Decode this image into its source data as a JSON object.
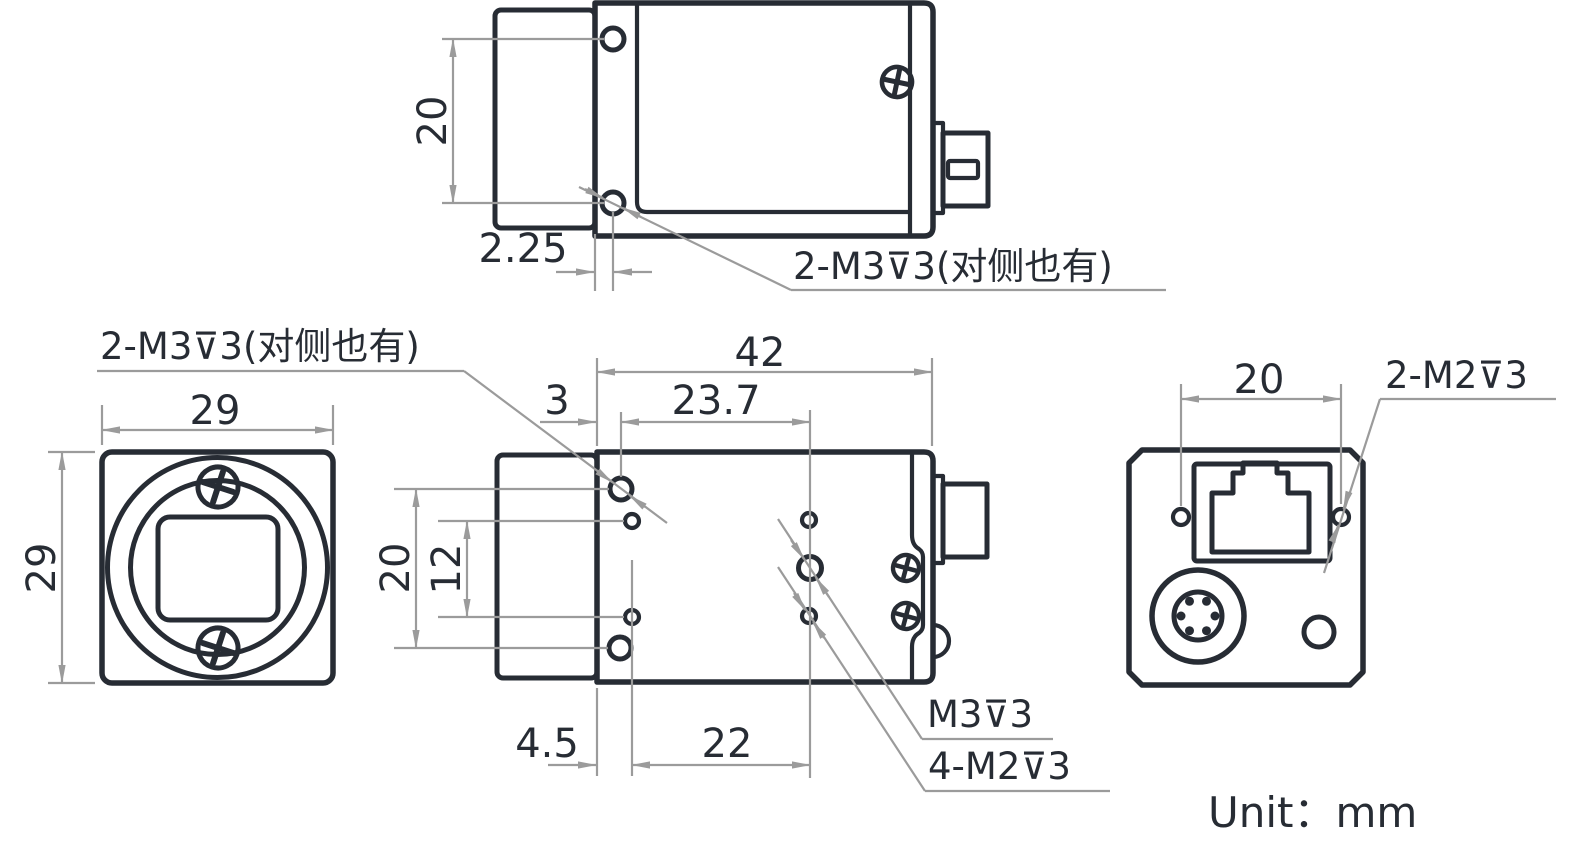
{
  "unit_note": "Unit：mm",
  "colors": {
    "outline": "#272c34",
    "dimension_gray": "#9b9b9b"
  },
  "views": {
    "top_view": {
      "name": "top view",
      "thread_label": "2-M3⊽3(对侧也有)",
      "dims": {
        "hole_spacing": "20",
        "edge_to_hole": "2.25"
      }
    },
    "front_view": {
      "name": "front view",
      "dims": {
        "width": "29",
        "height": "29"
      }
    },
    "side_view": {
      "name": "side view",
      "m3_pair_label": "2-M3⊽3(对侧也有)",
      "m3_label": "M3⊽3",
      "m2_label": "4-M2⊽3",
      "dims": {
        "length": "42",
        "front_to_m3_hole": "3",
        "m3_hole_spacing_h": "23.7",
        "m3_hole_spacing_v": "20",
        "m2_hole_spacing_v": "12",
        "front_to_m2_hole": "4.5",
        "m2_hole_spacing_h": "22"
      }
    },
    "back_view": {
      "name": "back view",
      "thread_label": "2-M2⊽3",
      "dims": {
        "hole_spacing": "20"
      }
    }
  }
}
